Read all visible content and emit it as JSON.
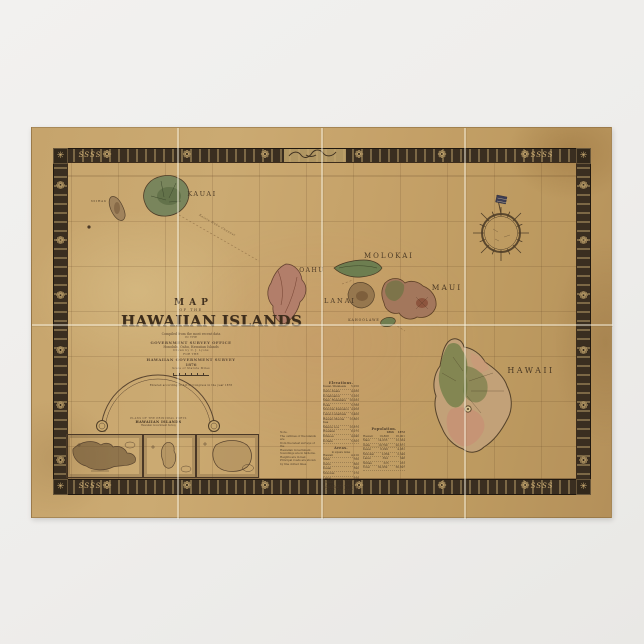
{
  "poster": {
    "background": "#efeeec"
  },
  "paper": {
    "base_color": "#c6a46c"
  },
  "border": {
    "band_color": "#3a2e20",
    "accent_color": "#d2b277",
    "floret_glyph": "❁",
    "corner_glyph": "✳",
    "scroll_text": "SSSS"
  },
  "title": {
    "map": "MAP",
    "of_the": "OF THE",
    "main": "HAWAIIAN ISLANDS",
    "attribution": [
      "Compiled from the most recent data",
      "IN THE",
      "GOVERNMENT SURVEY OFFICE",
      "Honolulu, Oahu, Hawaiian Islands",
      "Drawn by C. J. Lyons",
      "FOR THE",
      "HAWAIIAN GOVERNMENT SURVEY",
      "1876",
      "Scale of Statute Miles"
    ],
    "copyright": "Entered according to Act of Congress in the year 1876"
  },
  "islands": [
    {
      "id": "kauai",
      "label": "KAUAI"
    },
    {
      "id": "niihau",
      "label": "NIIHAU"
    },
    {
      "id": "oahu",
      "label": "OAHU"
    },
    {
      "id": "molokai",
      "label": "MOLOKAI"
    },
    {
      "id": "lanai",
      "label": "LANAI"
    },
    {
      "id": "maui",
      "label": "MAUI"
    },
    {
      "id": "kahoolawe",
      "label": "KAHOOLAWE"
    },
    {
      "id": "hawaii",
      "label": "HAWAII"
    }
  ],
  "sea": {
    "channel_label": "Kaieie Waho Channel"
  },
  "insets": {
    "arc_line": "PLANS OF THE PRINCIPAL PORTS",
    "arc_title": "HAWAIIAN ISLANDS",
    "arc_sub": "Hawaiian Government Survey"
  },
  "tables": {
    "elevations": {
      "title": "Elevations.",
      "rows": [
        {
          "n": "Kauai–Waialeale",
          "v": "5,250"
        },
        {
          "n": "Oahu–Kaala",
          "v": "4,030"
        },
        {
          "n": "Konahuanui",
          "v": "3,105"
        },
        {
          "n": "Maui–Haleakala",
          "v": "10,032"
        },
        {
          "n": "Eeka",
          "v": "5,788"
        },
        {
          "n": "Molokai–Kamakou",
          "v": "4,958"
        },
        {
          "n": "Lanai–Lanaihale",
          "v": "3,400"
        },
        {
          "n": "Hawaii–Mauna Kea",
          "v": "13,805"
        },
        {
          "n": "Mauna Loa",
          "v": "13,675"
        },
        {
          "n": "Hualalai",
          "v": "8,275"
        },
        {
          "n": "Kilauea",
          "v": "4,040"
        },
        {
          "n": "Kohala",
          "v": "5,505"
        }
      ]
    },
    "areas": {
      "title": "Areas.",
      "sub": "in square miles",
      "rows": [
        {
          "n": "Hawaii",
          "v": "4,210"
        },
        {
          "n": "Maui",
          "v": "760"
        },
        {
          "n": "Oahu",
          "v": "600"
        },
        {
          "n": "Kauai",
          "v": "590"
        },
        {
          "n": "Molokai",
          "v": "270"
        },
        {
          "n": "Lanai",
          "v": "150"
        },
        {
          "n": "Niihau",
          "v": "97"
        },
        {
          "n": "Kahoolawe",
          "v": "63"
        }
      ]
    },
    "population": {
      "title": "Population.",
      "col1": "1866",
      "col2": "1872",
      "rows": [
        {
          "n": "Hawaii",
          "v1": "19,808",
          "v2": "16,001"
        },
        {
          "n": "Maui",
          "v1": "14,035",
          "v2": "12,334"
        },
        {
          "n": "Oahu",
          "v1": "19,799",
          "v2": "20,671"
        },
        {
          "n": "Kauai",
          "v1": "6,299",
          "v2": "4,961"
        },
        {
          "n": "Molokai",
          "v1": "2,864",
          "v2": "2,349"
        },
        {
          "n": "Lanai",
          "v1": "394",
          "v2": "348"
        },
        {
          "n": "Niihau",
          "v1": "325",
          "v2": "233"
        },
        {
          "n": "Total",
          "v1": "62,959",
          "v2": "56,897"
        }
      ]
    },
    "note": {
      "lines": [
        "Note.",
        "The outlines of the islands are",
        "from the latest surveys of the",
        "Hawaiian Government.",
        "Soundings are in fathoms.",
        "Heights are in feet.",
        "Principal roads are shown",
        "by fine dotted lines."
      ]
    }
  }
}
